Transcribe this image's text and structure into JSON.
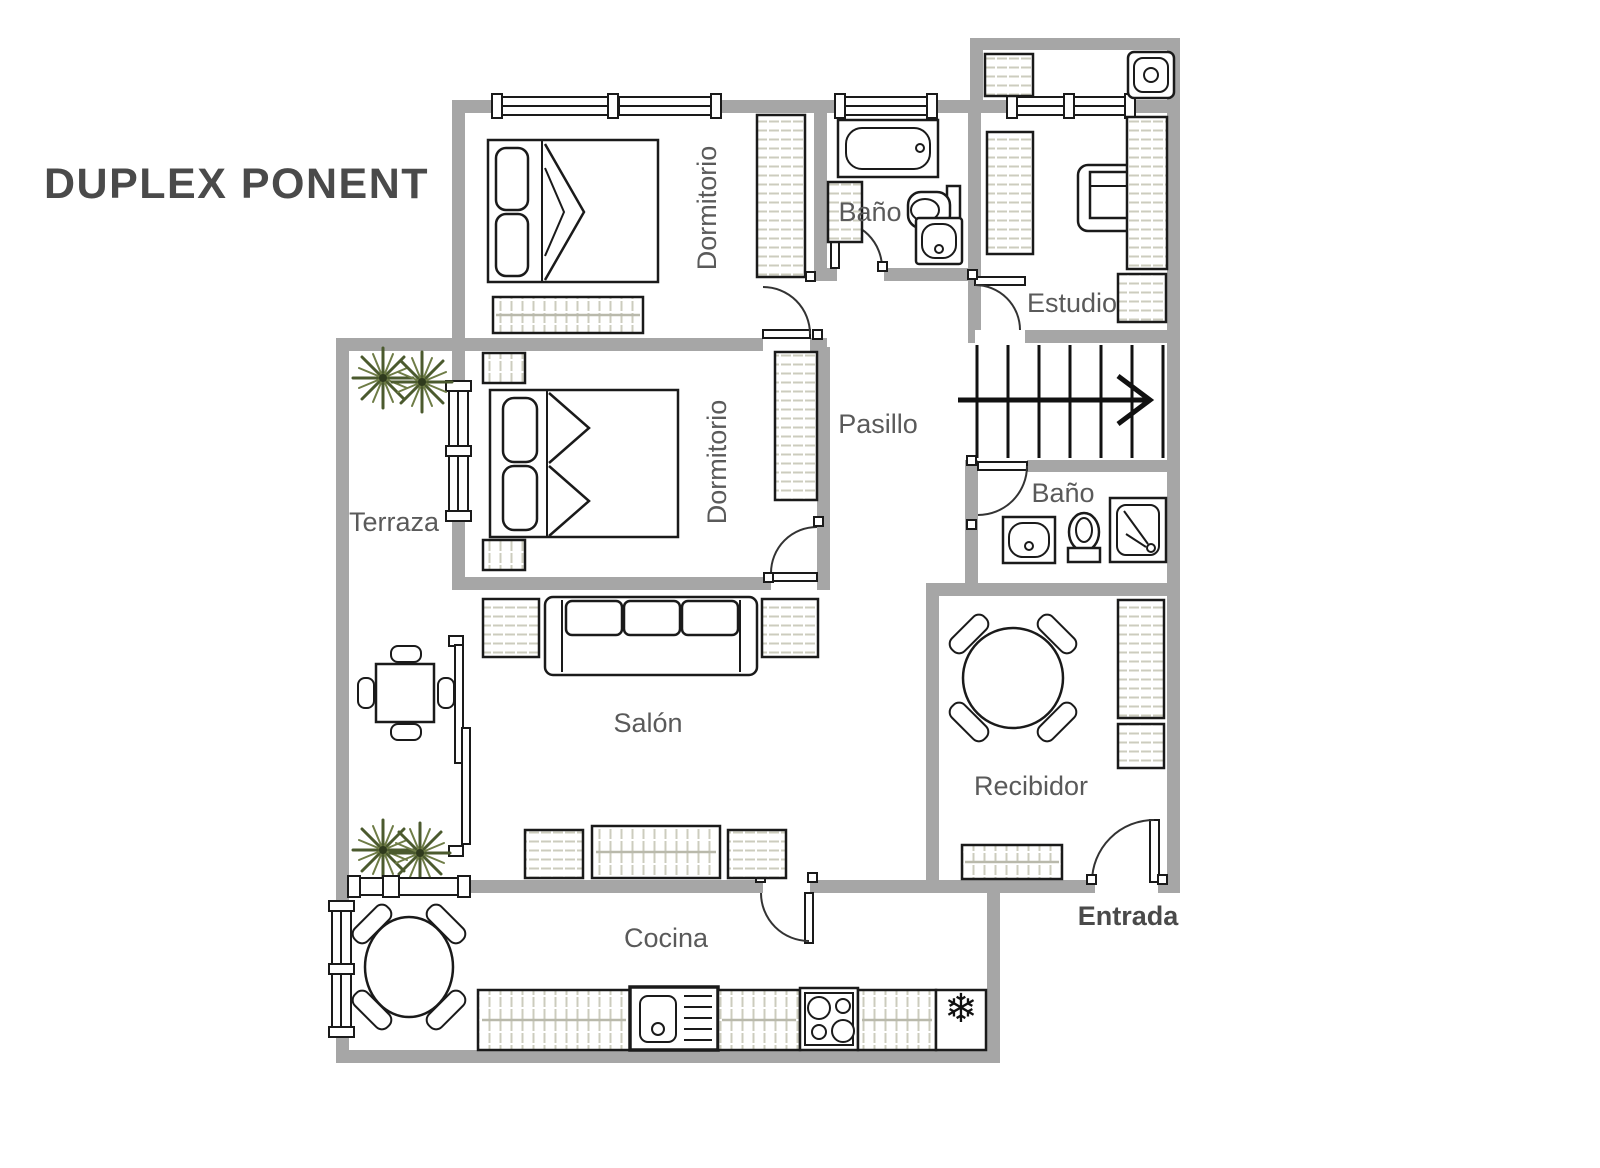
{
  "title": "DUPLEX PONENT",
  "rooms": {
    "dormitorio1": {
      "label": "Dormitorio"
    },
    "bano1": {
      "label": "Baño"
    },
    "estudio": {
      "label": "Estudio"
    },
    "pasillo": {
      "label": "Pasillo"
    },
    "dormitorio2": {
      "label": "Dormitorio"
    },
    "terraza": {
      "label": "Terraza"
    },
    "bano2": {
      "label": "Baño"
    },
    "salon": {
      "label": "Salón"
    },
    "recibidor": {
      "label": "Recibidor"
    },
    "cocina": {
      "label": "Cocina"
    },
    "entrada": {
      "label": "Entrada"
    }
  },
  "stairs": {
    "steps": 8,
    "direction": "right"
  },
  "kitchen": {
    "fridge_glyph": "❄",
    "appliances": [
      "counter",
      "sink",
      "hob-4-burners",
      "refrigerator"
    ]
  },
  "furniture_legend": [
    "double-bed",
    "wardrobe",
    "dresser",
    "radiator",
    "sofa-3-seat",
    "round-table-4-chairs",
    "square-table-4-chairs",
    "armchair",
    "bathtub",
    "toilet",
    "washbasin",
    "shower",
    "plant"
  ],
  "colors": {
    "wall": "#a6a6a6",
    "outline": "#1a1a1a",
    "hatch": "#ccccbe",
    "label": "#5a5a5a",
    "title": "#4a4a4a",
    "plant": "#4b5a2e"
  }
}
